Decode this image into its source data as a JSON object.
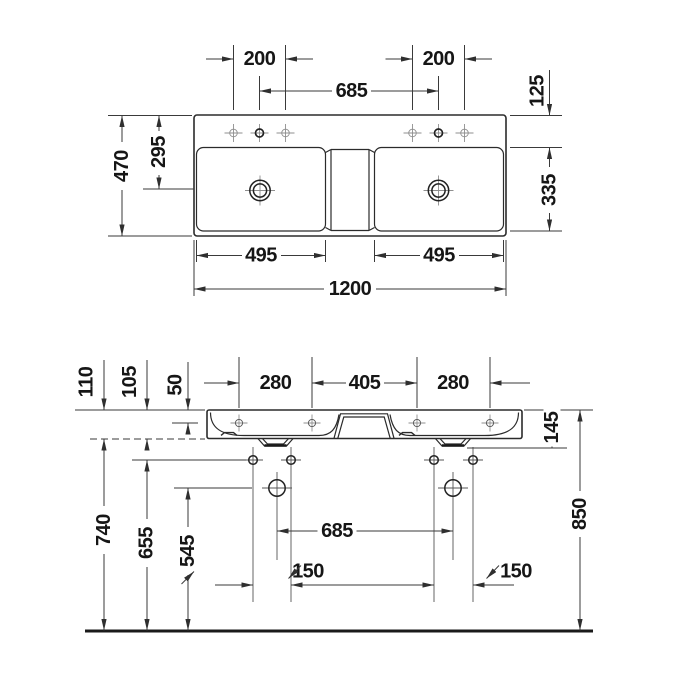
{
  "drawing": {
    "type": "technical-dimension-drawing",
    "subject": "double-washbasin",
    "palette": {
      "background": "#ffffff",
      "outline": "#2b2b2b",
      "dimension_line": "#3a3a3a",
      "centerline": "#8f8f8f",
      "text": "#161616"
    },
    "plan": {
      "dims": {
        "tap_hole_span_left": "200",
        "tap_hole_span_right": "200",
        "faucet_centres": "685",
        "back_to_bowl": "125",
        "overall_depth": "470",
        "back_to_drain": "295",
        "bowl_depth": "335",
        "bowl_width_left": "495",
        "bowl_width_right": "495",
        "overall_width": "1200"
      }
    },
    "elevation": {
      "dims": {
        "edge_height_left": "110",
        "edge_height_mid": "105",
        "top_to_tap_axis": "50",
        "tap_span_left": "280",
        "tap_span_centre": "405",
        "tap_span_right": "280",
        "body_with_drain_height": "145",
        "floor_to_bottom_edge": "740",
        "floor_to_fixing_holes": "655",
        "floor_to_anchor_holes": "545",
        "anchor_centres": "685",
        "fixing_offset_left": "150",
        "fixing_offset_right": "150",
        "installation_height": "850"
      }
    }
  }
}
